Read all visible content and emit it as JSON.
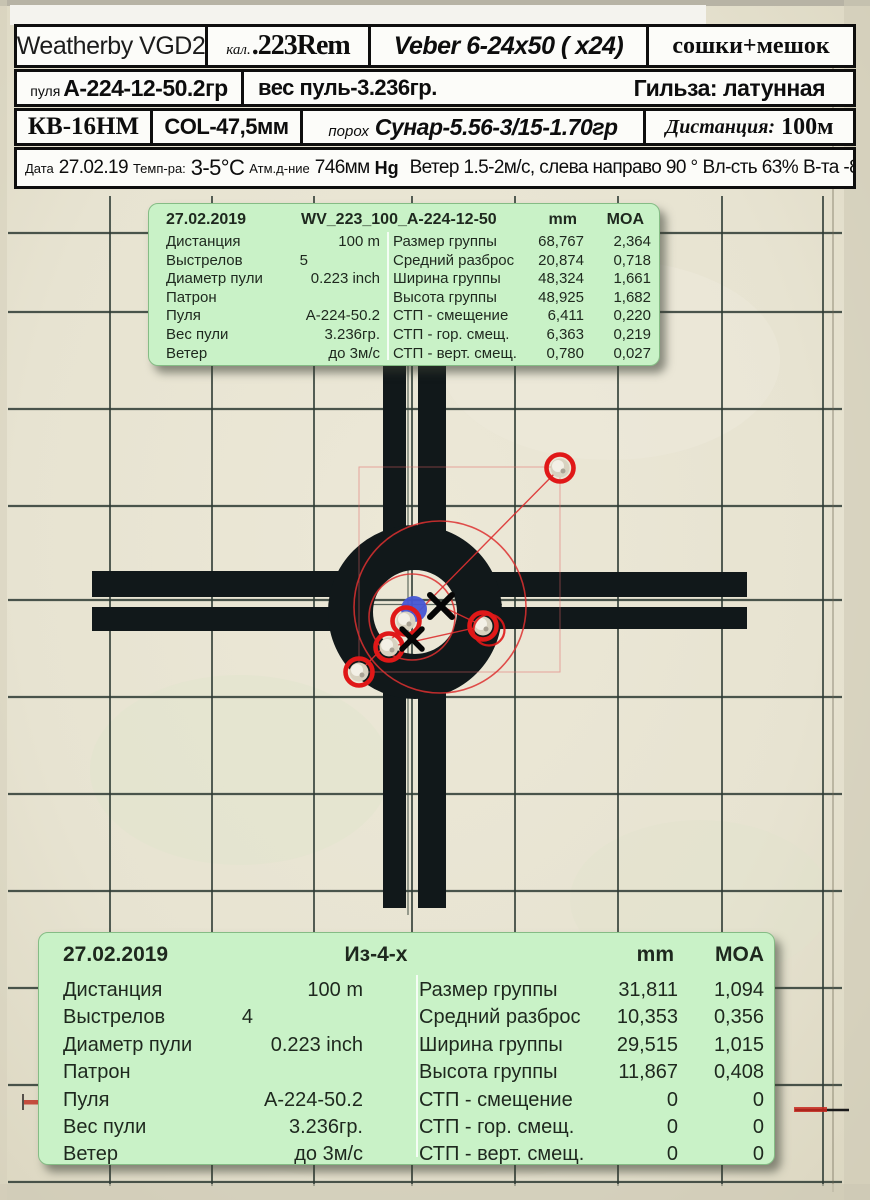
{
  "header": {
    "rifle": "Weatherby VGD2",
    "caliber_label": "кал.",
    "caliber": ".223Rem",
    "scope": "Veber 6-24x50 ( x24)",
    "rest": "сошки+мешок",
    "bullet_label": "пуля",
    "bullet": "А-224-12-50.2гр",
    "bullet_weight": "вес пуль-3.236гр.",
    "case": "Гильза:  латунная",
    "primer": "КВ-16НМ",
    "col": "COL-47,5мм",
    "powder_label": "порох",
    "powder": "Сунар-5.56-3/15-1.70гр",
    "distance_label": "Дистанция:",
    "distance": "100м",
    "conditions": {
      "date_label": "Дата",
      "date": "27.02.19",
      "temp_label": "Темп-ра:",
      "temp": "3-5°С",
      "pressure_label": "Атм.д-ние",
      "pressure": "746мм",
      "pressure_unit": "Hg",
      "wind": "Ветер 1.5-2м/с, слева направо 90 °",
      "humidity": "Вл-сть 63%",
      "altitude": "В-та -84м"
    }
  },
  "stats_top": {
    "date": "27.02.2019",
    "title": "WV_223_100_A-224-12-50",
    "col_mm": "mm",
    "col_moa": "MOA",
    "left": [
      {
        "label": "Дистанция",
        "value": "100  m"
      },
      {
        "label": "Выстрелов",
        "value": "5"
      },
      {
        "label": "Диаметр пули",
        "value": "0.223  inch"
      },
      {
        "label": "Патрон",
        "value": ""
      },
      {
        "label": "Пуля",
        "value": "А-224-50.2"
      },
      {
        "label": "Вес пули",
        "value": "3.236гр."
      },
      {
        "label": "Ветер",
        "value": "до 3м/с"
      }
    ],
    "right": [
      {
        "label": "Размер группы",
        "mm": "68,767",
        "moa": "2,364"
      },
      {
        "label": "Средний разброс",
        "mm": "20,874",
        "moa": "0,718"
      },
      {
        "label": "Ширина группы",
        "mm": "48,324",
        "moa": "1,661"
      },
      {
        "label": "Высота группы",
        "mm": "48,925",
        "moa": "1,682"
      },
      {
        "label": "СТП - смещение",
        "mm": "6,411",
        "moa": "0,220"
      },
      {
        "label": "СТП - гор. смещ.",
        "mm": "6,363",
        "moa": "0,219"
      },
      {
        "label": "СТП - верт. смещ.",
        "mm": "0,780",
        "moa": "0,027"
      }
    ]
  },
  "stats_bottom": {
    "date": "27.02.2019",
    "title": "Из-4-х",
    "col_mm": "mm",
    "col_moa": "MOA",
    "left": [
      {
        "label": "Дистанция",
        "value": "100  m"
      },
      {
        "label": "Выстрелов",
        "value": "4"
      },
      {
        "label": "Диаметр пули",
        "value": "0.223  inch"
      },
      {
        "label": "Патрон",
        "value": ""
      },
      {
        "label": "Пуля",
        "value": "А-224-50.2"
      },
      {
        "label": "Вес пули",
        "value": "3.236гр."
      },
      {
        "label": "Ветер",
        "value": "до 3м/с"
      }
    ],
    "right": [
      {
        "label": "Размер группы",
        "mm": "31,811",
        "moa": "1,094"
      },
      {
        "label": "Средний разброс",
        "mm": "10,353",
        "moa": "0,356"
      },
      {
        "label": "Ширина группы",
        "mm": "29,515",
        "moa": "1,015"
      },
      {
        "label": "Высота группы",
        "mm": "11,867",
        "moa": "0,408"
      },
      {
        "label": "СТП - смещение",
        "mm": "0",
        "moa": "0"
      },
      {
        "label": "СТП - гор. смещ.",
        "mm": "0",
        "moa": "0"
      },
      {
        "label": "СТП - верт. смещ.",
        "mm": "0",
        "moa": "0"
      }
    ]
  },
  "target": {
    "grid_x": [
      110,
      212,
      314,
      412,
      515,
      618,
      722,
      823
    ],
    "grid_y": [
      233,
      312,
      409,
      506,
      600,
      697,
      794,
      891,
      988,
      1085,
      1182
    ],
    "shots": [
      {
        "x": 560,
        "y": 468
      },
      {
        "x": 406,
        "y": 621
      },
      {
        "x": 389,
        "y": 647
      },
      {
        "x": 359,
        "y": 672
      },
      {
        "x": 483,
        "y": 626,
        "double_ring": true
      }
    ],
    "aim_dot": {
      "x": 414,
      "y": 609,
      "r": 13
    },
    "stp_marks": [
      {
        "x": 441,
        "y": 606,
        "half": 11,
        "w": 6
      },
      {
        "x": 412,
        "y": 639,
        "half": 10,
        "w": 5.5
      }
    ],
    "spread_circles": [
      {
        "cx": 440,
        "cy": 607,
        "r": 86
      },
      {
        "cx": 412,
        "cy": 617,
        "r": 43
      }
    ],
    "group_lines": [
      [
        560,
        468,
        359,
        672
      ],
      [
        389,
        647,
        483,
        626
      ],
      [
        441,
        606,
        483,
        626
      ]
    ],
    "bounds_rect": {
      "x": 359,
      "y": 467,
      "w": 201,
      "h": 205
    },
    "colors": {
      "paper": "#e8e4d2",
      "grid": "#2e3b34",
      "ink": "#11181a",
      "red": "#e01818",
      "red_thin": "#dd3030",
      "blue": "#4656d4",
      "hole_fill": "#d8d2c0",
      "hole_light": "#f3f0e6"
    }
  }
}
